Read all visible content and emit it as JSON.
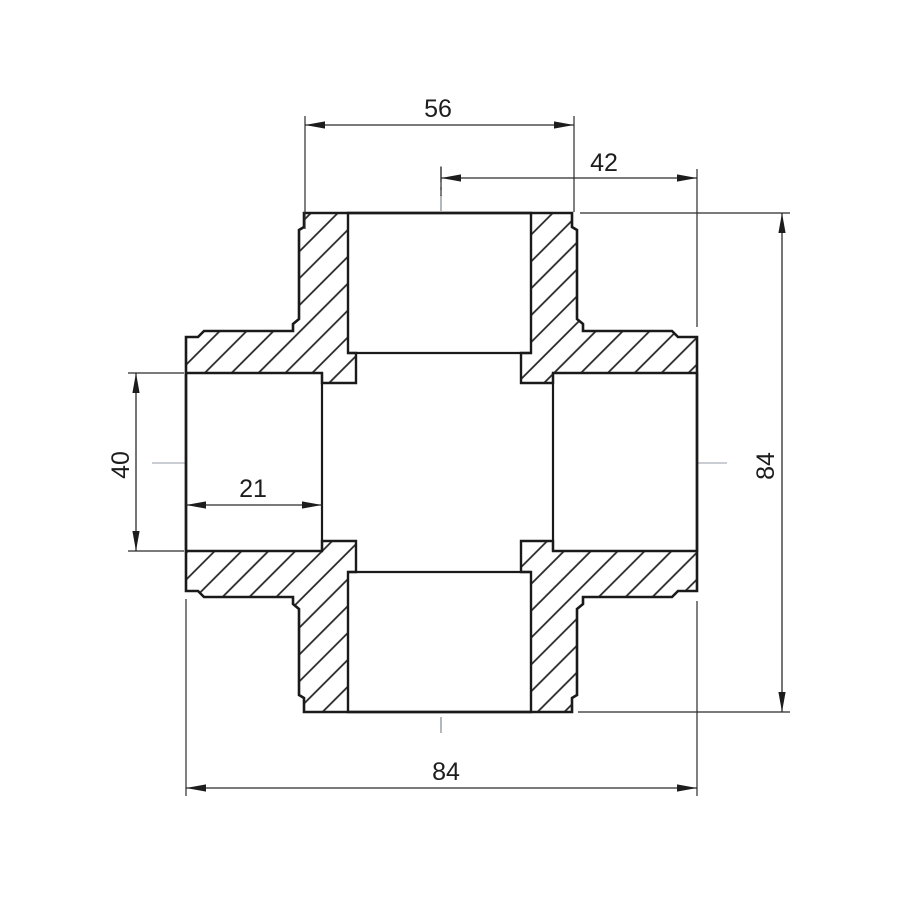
{
  "drawing": {
    "title": "cross-fitting-section-drawing",
    "dimensions": {
      "top_socket_width": "56",
      "center_to_right": "42",
      "socket_bore": "40",
      "socket_depth": "21",
      "overall_width": "84",
      "overall_height": "84"
    },
    "colors": {
      "line": "#1a1a1a",
      "dimension": "#2b2b2b",
      "centerline": "#9aa0a6",
      "background": "#ffffff"
    }
  }
}
